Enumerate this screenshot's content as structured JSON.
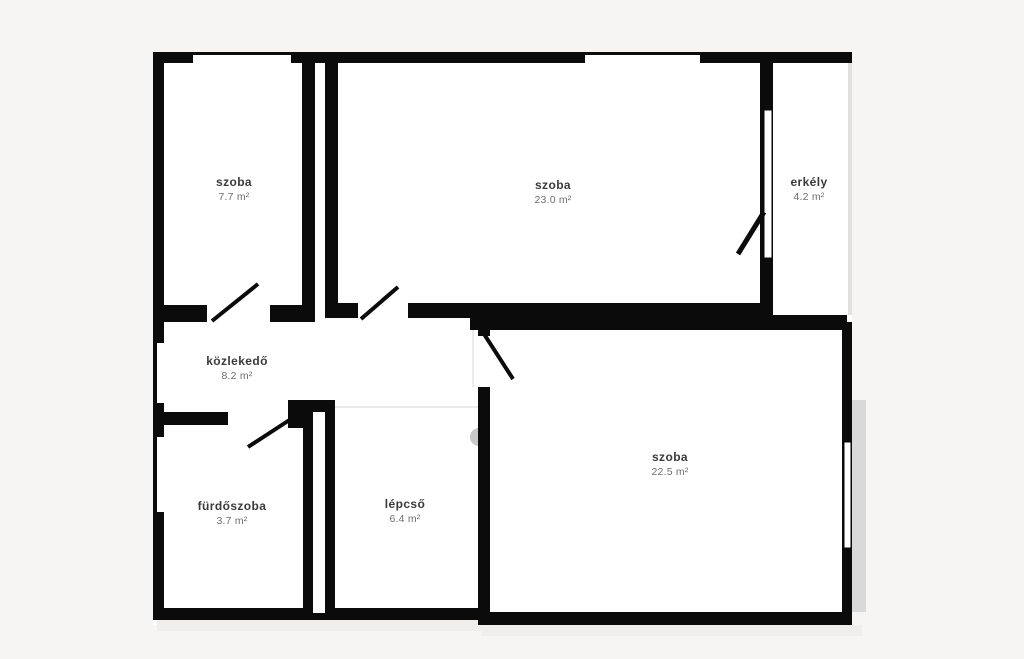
{
  "plan": {
    "type": "floor-plan",
    "language": "hu",
    "colors": {
      "wall": "#0b0b0b",
      "room_fill": "#ffffff",
      "background": "#f6f5f3",
      "shadow": "#d9d9d9",
      "balcony_railing": "#e2e0dd",
      "watermark": "#c9c9c9"
    }
  },
  "rooms": [
    {
      "name": "szoba",
      "area": "7.7 m²"
    },
    {
      "name": "szoba",
      "area": "23.0 m²"
    },
    {
      "name": "erkély",
      "area": "4.2 m²"
    },
    {
      "name": "közlekedő",
      "area": "8.2 m²"
    },
    {
      "name": "fürdőszoba",
      "area": "3.7 m²"
    },
    {
      "name": "lépcső",
      "area": "6.4 m²"
    },
    {
      "name": "szoba",
      "area": "22.5 m²"
    }
  ]
}
